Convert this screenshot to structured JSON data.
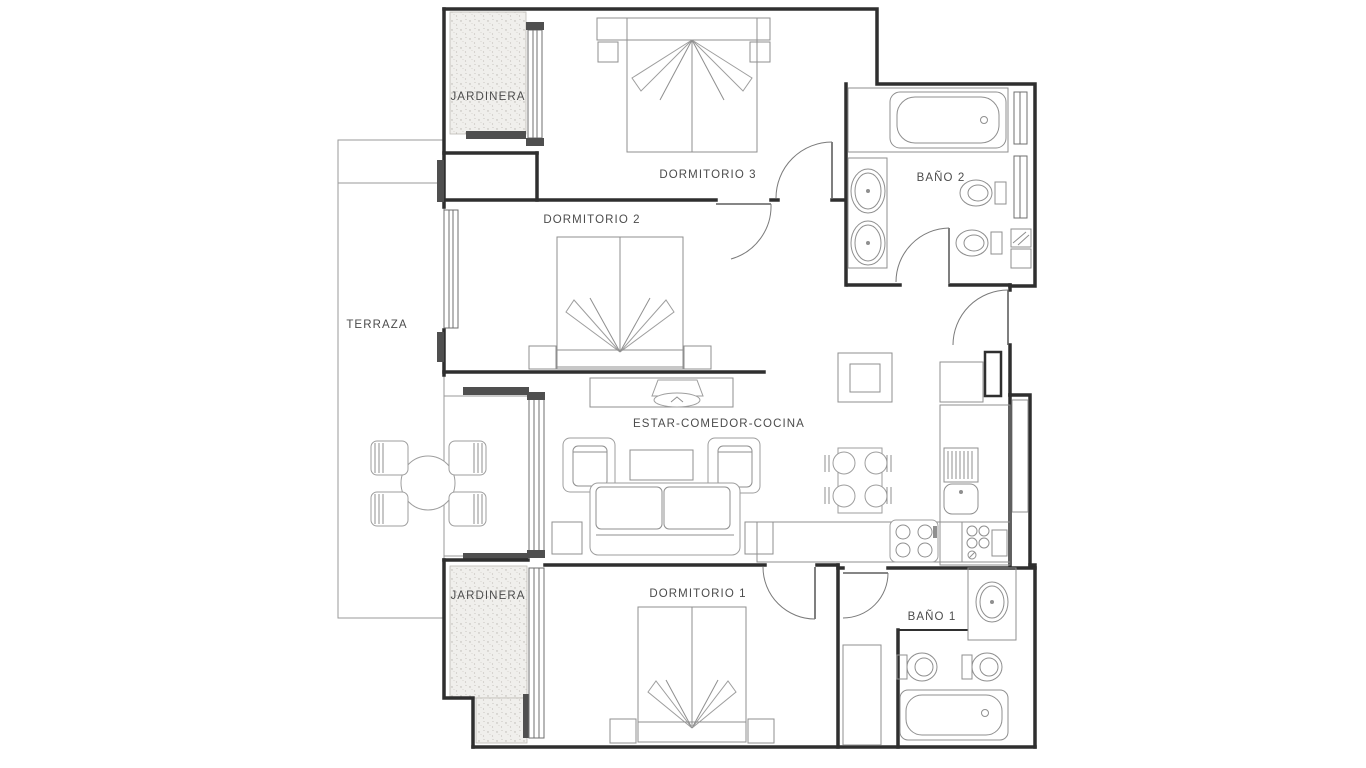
{
  "plan_type": "apartment-floor-plan",
  "rooms": {
    "jardinera_top": "JARDINERA",
    "dormitorio3": "DORMITORIO 3",
    "bano2": "BAÑO 2",
    "dormitorio2": "DORMITORIO 2",
    "terraza": "TERRAZA",
    "estar": "ESTAR-COMEDOR-COCINA",
    "dormitorio1": "DORMITORIO 1",
    "jardinera_bottom": "JARDINERA",
    "bano1": "BAÑO 1"
  },
  "colors": {
    "background": "#ffffff",
    "wall": "#2f2f2f",
    "furniture_line": "#8f8f8f",
    "brick_line": "#cdcdcd",
    "label_text": "#4c4c4c"
  }
}
